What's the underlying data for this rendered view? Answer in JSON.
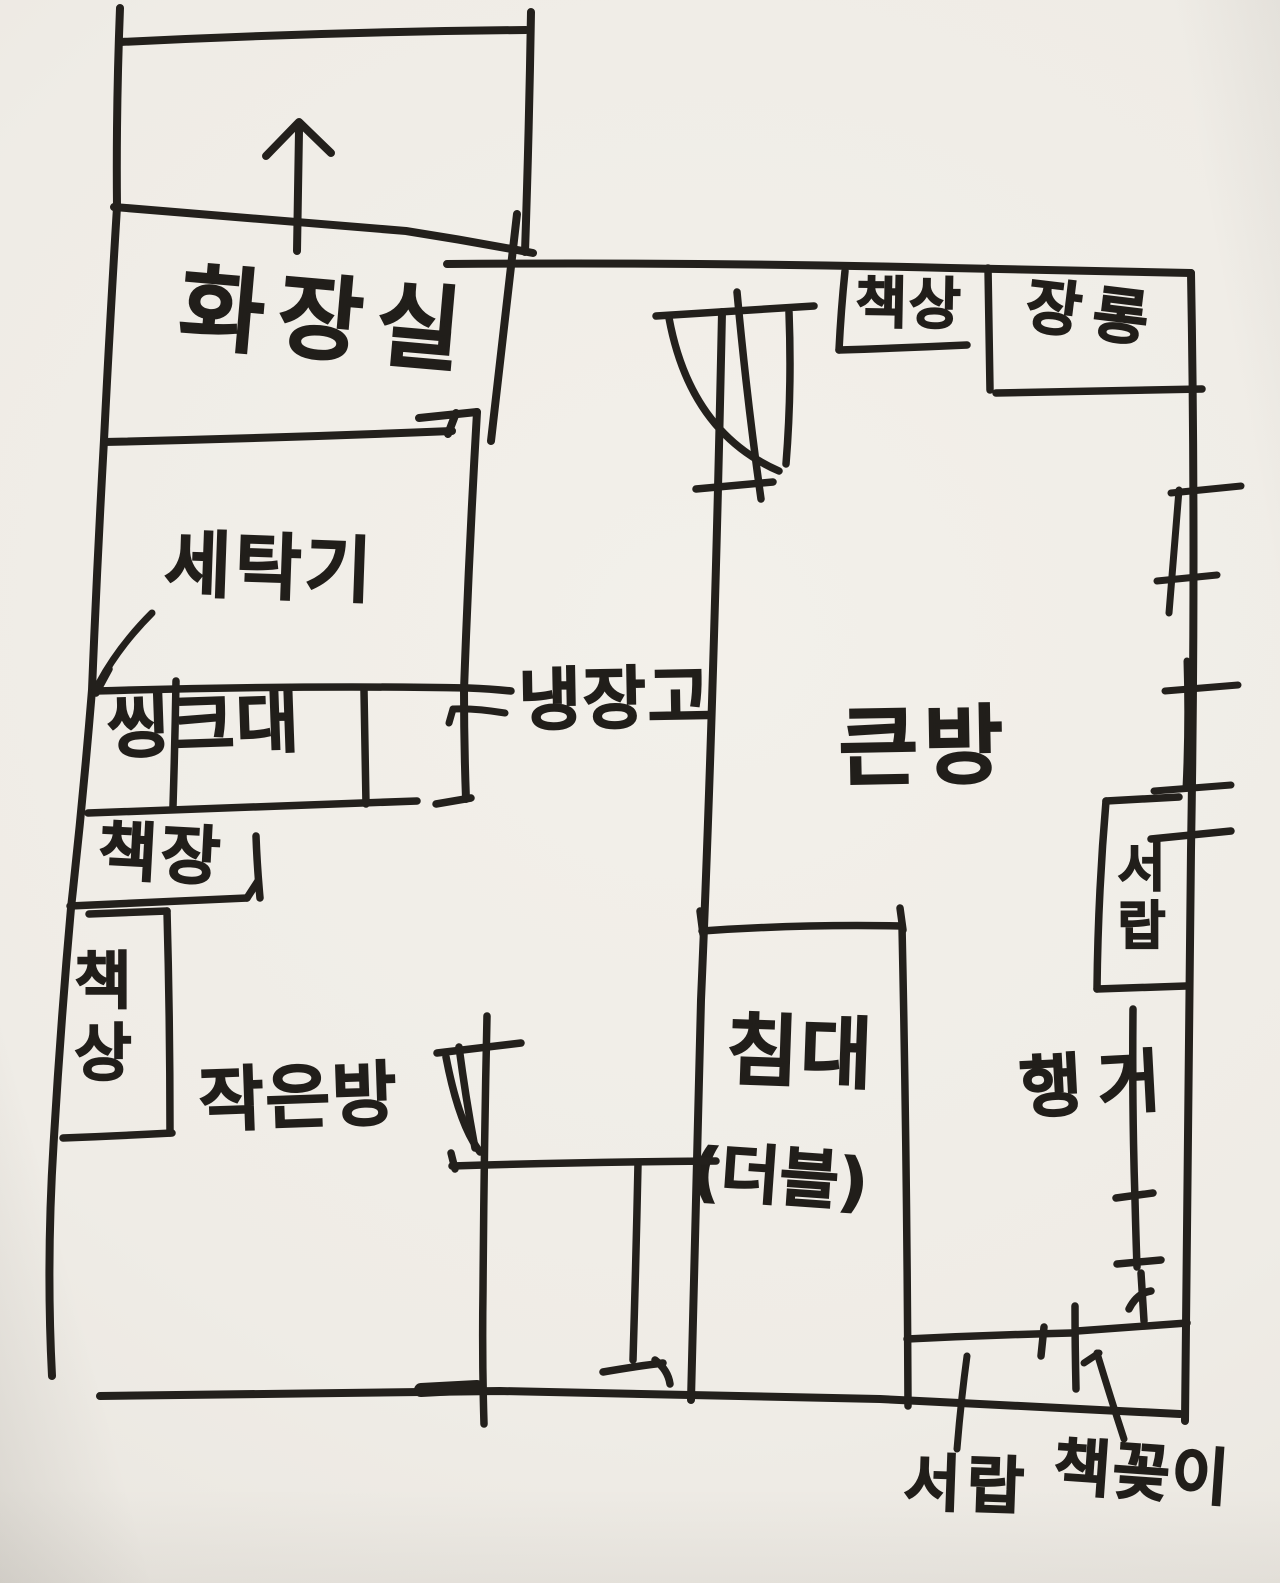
{
  "drawing": {
    "kind": "hand-drawn apartment floor plan",
    "ink_color": "#23201c",
    "paper_color": "#efece6"
  },
  "rooms": {
    "bathroom": "화장실",
    "small_room": "작은방",
    "big_room": "큰방"
  },
  "fixtures": {
    "washing_machine": "세탁기",
    "sink": "씽크대",
    "refrigerator": "냉장고",
    "bookshelf_left": "책장",
    "desk_left": "책상",
    "bed": "침대",
    "bed_type": "(더블)",
    "desk_top_right": "책상",
    "wardrobe": "장롱",
    "drawer_right": "서랍",
    "hanger": "행거",
    "drawer_bottom": "서랍",
    "bookcase_bottom": "책꽂이"
  },
  "icons": {
    "direction_arrow": "up-arrow"
  }
}
